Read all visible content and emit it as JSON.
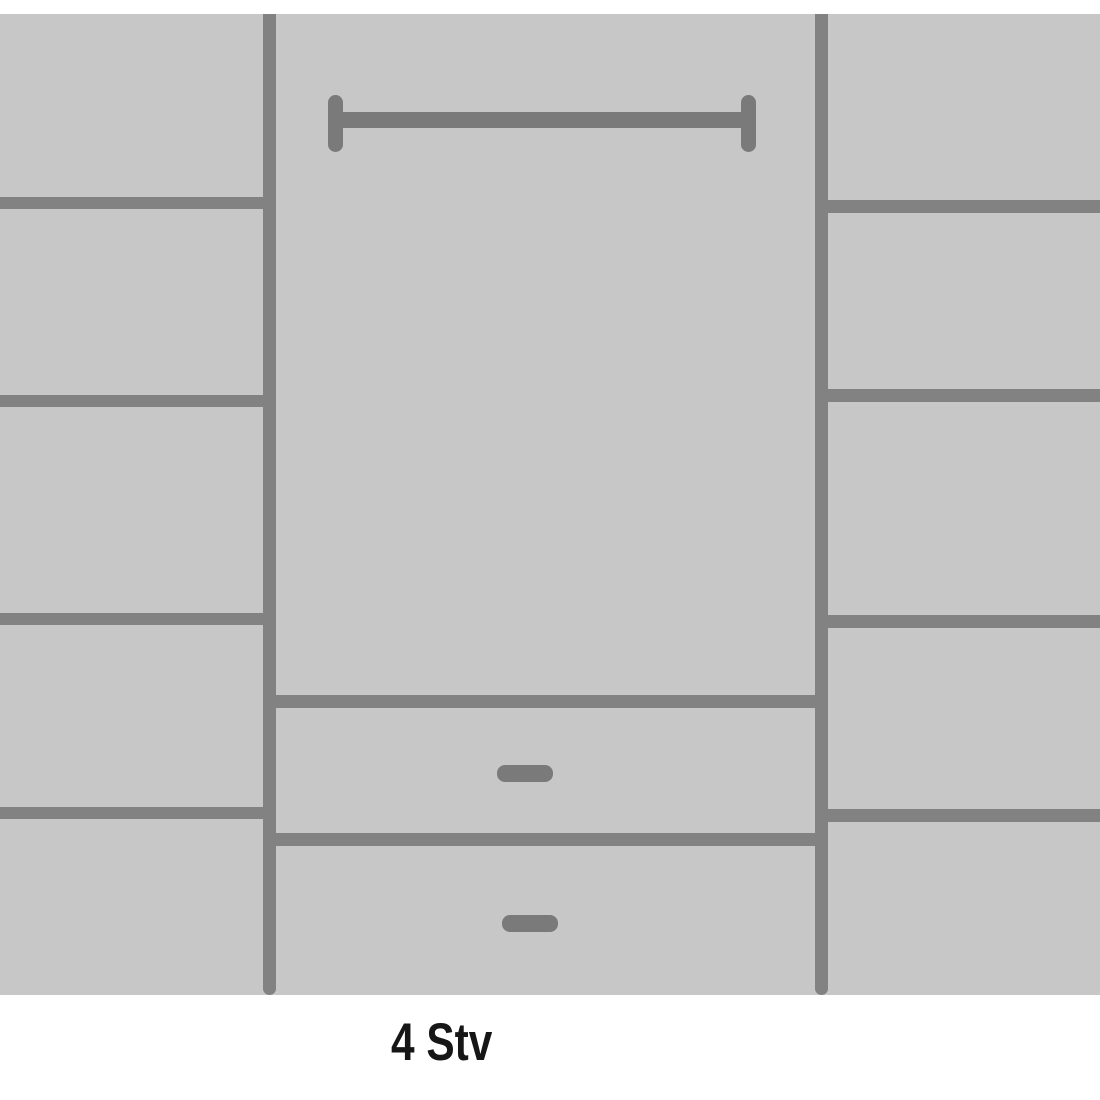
{
  "caption": {
    "label": "4 Stv"
  },
  "diagram": {
    "type": "wardrobe-interior-schematic",
    "left_column": {
      "compartments": 5,
      "shelves": 4
    },
    "right_column": {
      "compartments": 5,
      "shelves": 4
    },
    "center_section": {
      "hanging_rails": 1,
      "drawers": 2,
      "drawer_handles": 2
    }
  },
  "colors": {
    "background": "#ffffff",
    "panel": "#c7c7c7",
    "line": "#828282",
    "hardware": "#7a7a7a",
    "text": "#161616"
  }
}
